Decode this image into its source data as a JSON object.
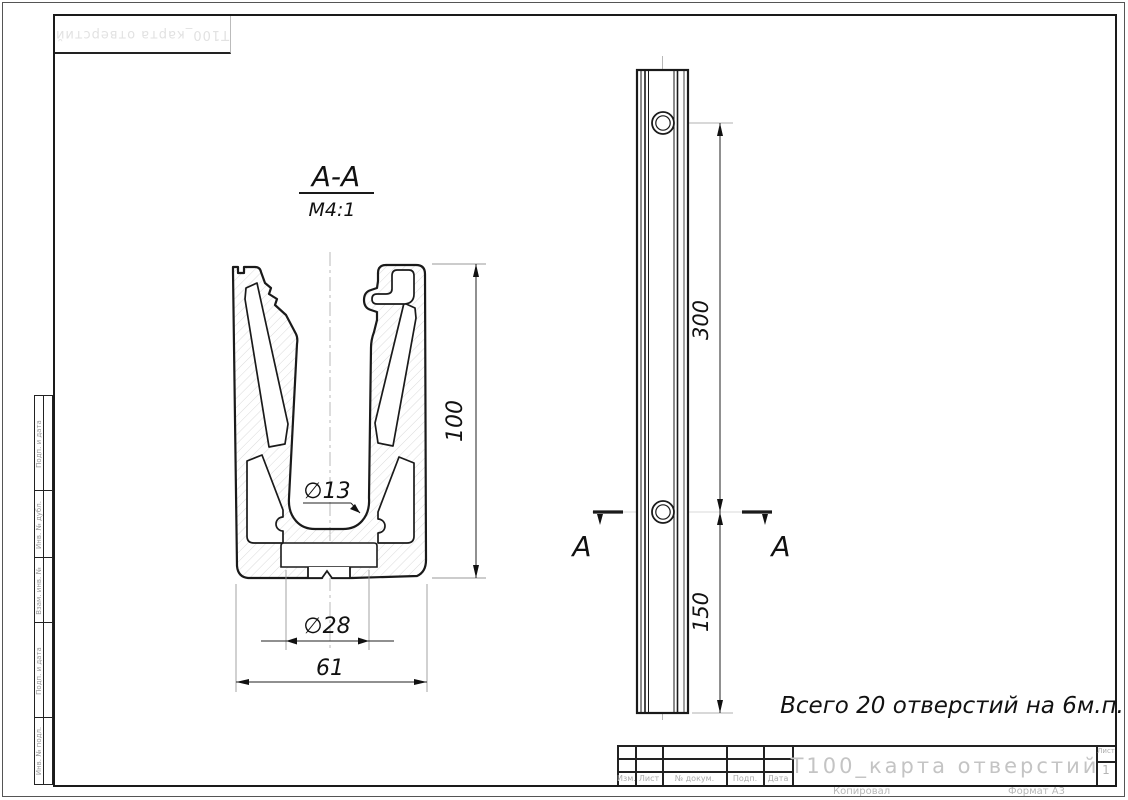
{
  "top_stamp": {
    "text": "Т100_карта отверстий"
  },
  "margin_table": {
    "labels": [
      "Подп. и дата",
      "Инв. № дубл.",
      "Взам. инв. №",
      "Подп. и дата",
      "Инв. № подл."
    ]
  },
  "section_view": {
    "label": "А-А",
    "scale": "М4:1",
    "dim_height": "100",
    "dim_hole_small": "∅13",
    "dim_hole_big": "∅28",
    "dim_width": "61"
  },
  "side_view": {
    "dim_hole_spacing": "300",
    "dim_end_offset": "150",
    "cut_letter_left": "А",
    "cut_letter_right": "А"
  },
  "note": {
    "text": "Всего 20 отверстий на 6м.п."
  },
  "title_block": {
    "title": "Т100_карта отверстий",
    "footer_labels": [
      "Изм.",
      "Лист",
      "№ докум.",
      "Подп.",
      "Дата"
    ],
    "sheet_label": "Лист",
    "sheet_number": "1",
    "copy_label": "Копировал",
    "format_label": "Формат А3"
  },
  "colors": {
    "line": "#1a1a1a",
    "faint": "#999999",
    "centerline": "#b0b0b0",
    "hatch": "#d6d6d6"
  }
}
